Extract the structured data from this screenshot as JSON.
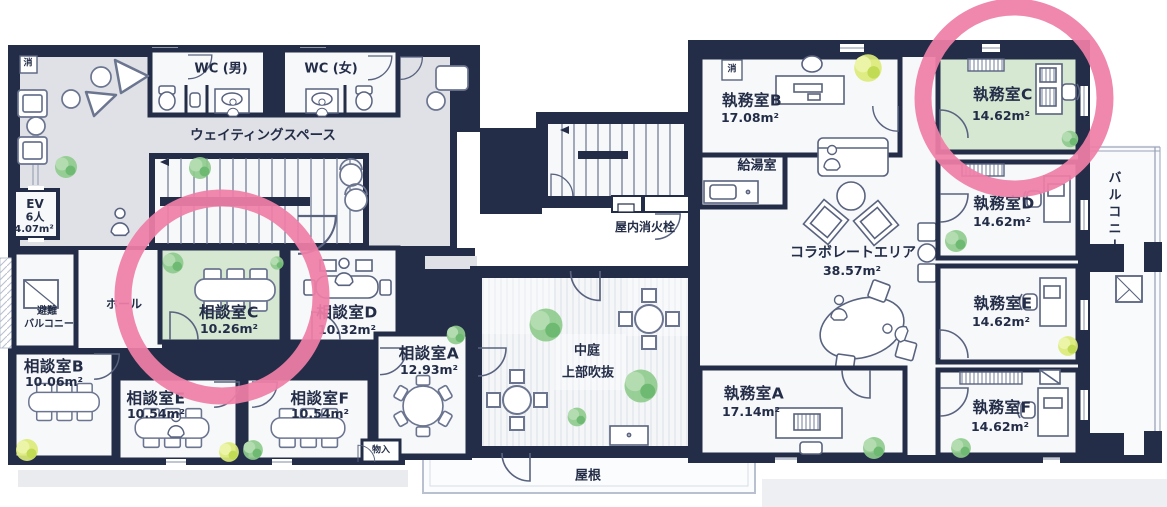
{
  "colors": {
    "wall": "#232d47",
    "floor": "#f7f8fa",
    "waiting_floor": "#dfe1e6",
    "highlight_room_fill": "#d6e7d2",
    "highlight_circle": "#ef7ea7",
    "tree_green": "#8ecb8d",
    "tree_yellow": "#dcea7a",
    "light_line": "#b9c0cf"
  },
  "annotations": {
    "highlighted_rooms": [
      "相談室C",
      "執務室C"
    ],
    "highlight_style": "pink-circle"
  },
  "facility": {
    "waiting_space": "ウェイティングスペース",
    "wc_male": "WC (男)",
    "wc_female": "WC (女)",
    "ev": {
      "line1": "EV",
      "line2": "6人",
      "area": "4.07m²"
    },
    "evac_balcony": {
      "line1": "避難",
      "line2": "バルコニー"
    },
    "hall": "ホール",
    "courtyard": {
      "line1": "中庭",
      "line2": "上部吹抜"
    },
    "indoor_fire_hydrant": "屋内消火栓",
    "kitchenette": "給湯室",
    "collab_area": {
      "name": "コラボレートエリア",
      "area": "38.57m²"
    },
    "balcony": "バルコニー",
    "roof": "屋根",
    "storage": "物入",
    "fire_extinguisher": "消"
  },
  "rooms": {
    "sodan_a": {
      "name": "相談室A",
      "area": "12.93m²"
    },
    "sodan_b": {
      "name": "相談室B",
      "area": "10.06m²"
    },
    "sodan_c": {
      "name": "相談室C",
      "area": "10.26m²",
      "highlighted": true
    },
    "sodan_d": {
      "name": "相談室D",
      "area": "10.32m²"
    },
    "sodan_e": {
      "name": "相談室E",
      "area": "10.54m²"
    },
    "sodan_f": {
      "name": "相談室F",
      "area": "10.54m²"
    },
    "shitsumu_a": {
      "name": "執務室A",
      "area": "17.14m²"
    },
    "shitsumu_b": {
      "name": "執務室B",
      "area": "17.08m²"
    },
    "shitsumu_c": {
      "name": "執務室C",
      "area": "14.62m²",
      "highlighted": true
    },
    "shitsumu_d": {
      "name": "執務室D",
      "area": "14.62m²"
    },
    "shitsumu_e": {
      "name": "執務室E",
      "area": "14.62m²"
    },
    "shitsumu_f": {
      "name": "執務室F",
      "area": "14.62m²"
    }
  }
}
